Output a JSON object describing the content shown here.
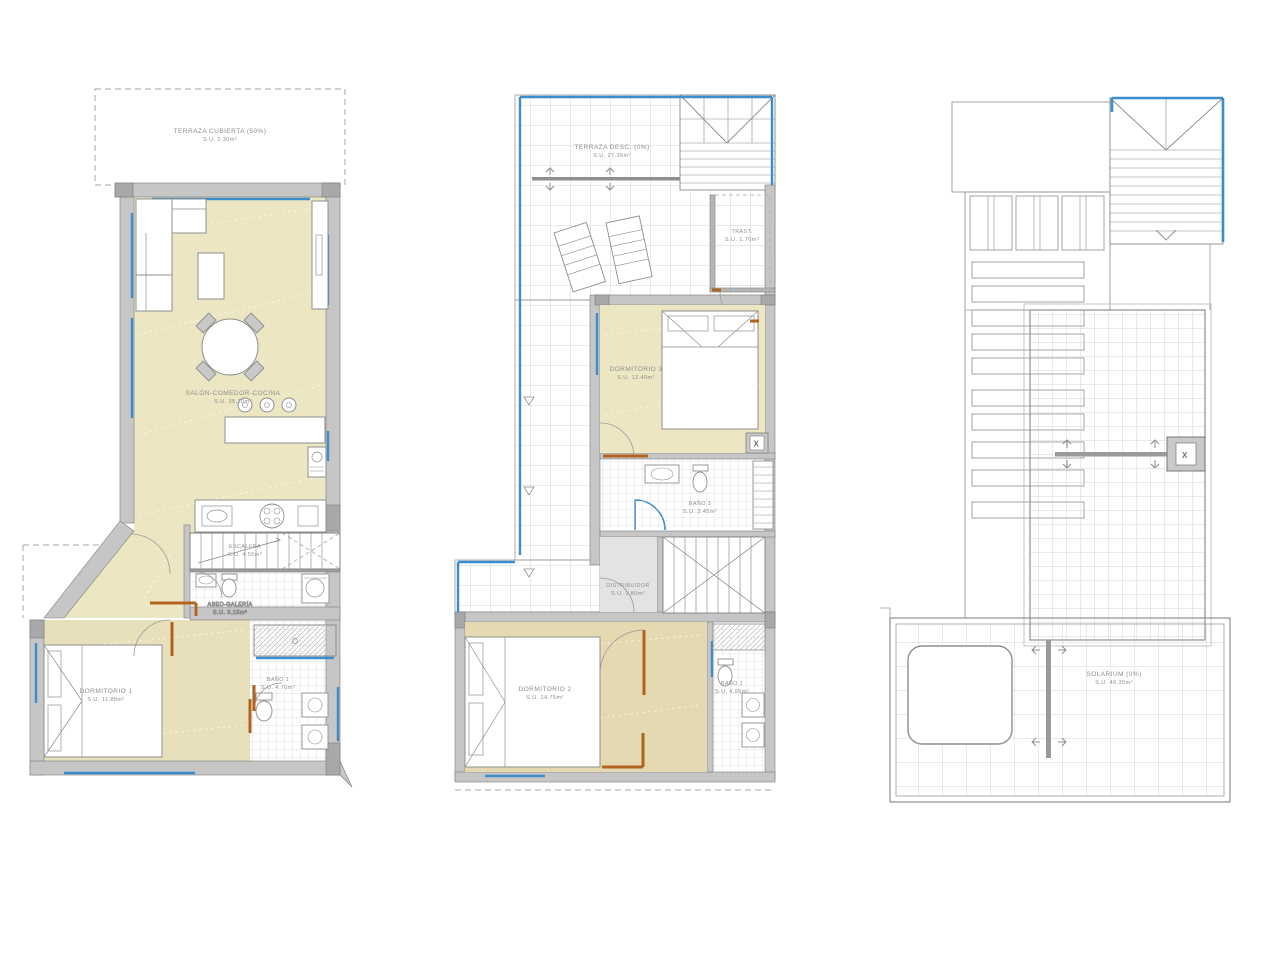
{
  "colors": {
    "accent_blue": "#3b8ecb",
    "wall_grey": "#c6c6c6",
    "floor_beige": "#ece6c3",
    "floor_tan": "#e5d9b2",
    "door_brown": "#b2641e"
  },
  "shunt_mark": "X",
  "plans": {
    "ground": {
      "rooms": {
        "terraza_cubierta": {
          "label": "TERRAZA CUBIERTA (50%)",
          "area": "S.U. 2.30m²"
        },
        "salon": {
          "label": "SALÓN-COMEDOR-COCINA",
          "area": "S.U. 35.20m²"
        },
        "escalera": {
          "label": "ESCALERA",
          "area": "S.U. 4.55m²"
        },
        "aseo_galeria": {
          "label": "ASEO-GALERÍA",
          "area": "S.U. 3.15m²"
        },
        "dormitorio1": {
          "label": "DORMITORIO 1",
          "area": "S.U. 11.88m²"
        },
        "bano1": {
          "label": "BAÑO 1",
          "area": "S.U. 4.70m²"
        }
      }
    },
    "first": {
      "rooms": {
        "terraza_desc": {
          "label": "TERRAZA DESC. (0%)",
          "area": "S.U. 27.35m²"
        },
        "trastero": {
          "label": "TRAST.",
          "area": "S.U. 1.70m²"
        },
        "dormitorio3": {
          "label": "DORMITORIO 3",
          "area": "S.U. 12.40m²"
        },
        "bano3": {
          "label": "BAÑO 3",
          "area": "S.U. 3.45m²"
        },
        "distribuidor": {
          "label": "DISTRIBUIDOR",
          "area": "S.U. 1.80m²"
        },
        "dormitorio2": {
          "label": "DORMITORIO 2",
          "area": "S.U. 14.75m²"
        },
        "bano2": {
          "label": "BAÑO 2",
          "area": "S.U. 4.95m²"
        }
      }
    },
    "roof": {
      "rooms": {
        "solarium": {
          "label": "SOLARIUM (0%)",
          "area": "S.U. 46.35m²"
        }
      }
    }
  }
}
